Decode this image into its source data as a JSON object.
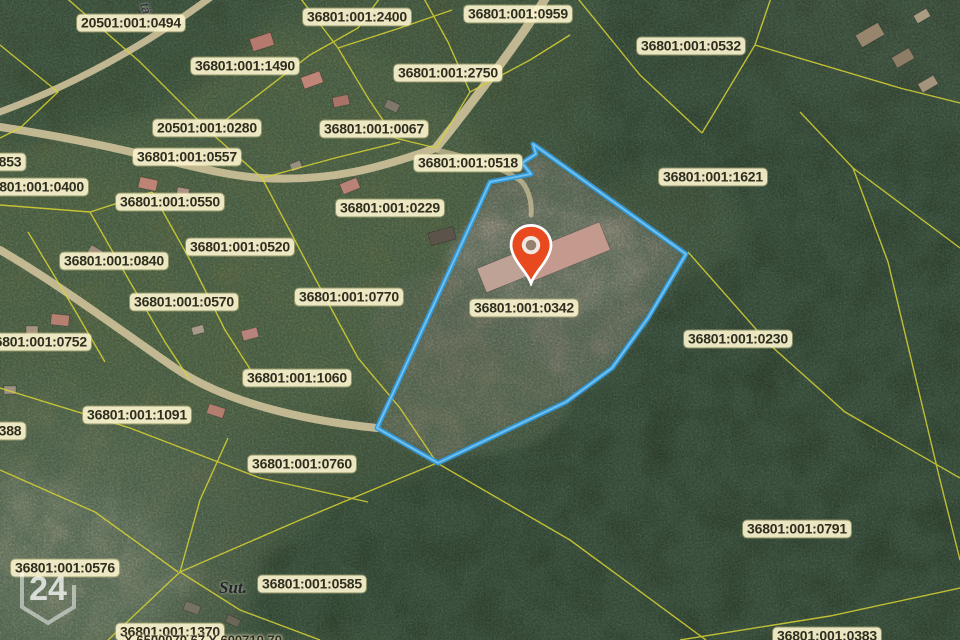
{
  "map": {
    "colors": {
      "selection_blue": "#2f9ce0",
      "selection_blue_light": "#7cc6ef",
      "boundary_yellow": "#d7d334",
      "pin_orange": "#e8491f",
      "road_tan": "#cfc29b",
      "label_bg": "rgba(250,243,205,0.92)",
      "label_text": "#2f2d1f"
    },
    "selected_parcel": "36801:001:0342",
    "parcel_labels": [
      {
        "text": "20501:001:0494",
        "x": 131,
        "y": 23
      },
      {
        "text": "36801:001:2400",
        "x": 357,
        "y": 17
      },
      {
        "text": "36801:001:0959",
        "x": 518,
        "y": 14
      },
      {
        "text": "36801:001:0532",
        "x": 691,
        "y": 46
      },
      {
        "text": "36801:001:1490",
        "x": 245,
        "y": 66
      },
      {
        "text": "36801:001:2750",
        "x": 448,
        "y": 73
      },
      {
        "text": "20501:001:0280",
        "x": 207,
        "y": 128
      },
      {
        "text": "36801:001:0067",
        "x": 374,
        "y": 129
      },
      {
        "text": "36801:001:0557",
        "x": 187,
        "y": 157
      },
      {
        "text": "853",
        "x": 10,
        "y": 162
      },
      {
        "text": "36801:001:0518",
        "x": 468,
        "y": 163,
        "layer": "under"
      },
      {
        "text": "36801:001:1621",
        "x": 713,
        "y": 177
      },
      {
        "text": "36801:001:0400",
        "x": 34,
        "y": 187
      },
      {
        "text": "36801:001:0550",
        "x": 170,
        "y": 202
      },
      {
        "text": "36801:001:0229",
        "x": 390,
        "y": 208
      },
      {
        "text": "36801:001:0520",
        "x": 240,
        "y": 247
      },
      {
        "text": "36801:001:0840",
        "x": 114,
        "y": 261
      },
      {
        "text": "36801:001:0770",
        "x": 349,
        "y": 297
      },
      {
        "text": "36801:001:0570",
        "x": 184,
        "y": 302
      },
      {
        "text": "36801:001:0342",
        "x": 524,
        "y": 308
      },
      {
        "text": "36801:001:0230",
        "x": 738,
        "y": 339
      },
      {
        "text": "36801:001:0752",
        "x": 37,
        "y": 342
      },
      {
        "text": "36801:001:1060",
        "x": 297,
        "y": 378
      },
      {
        "text": "36801:001:1091",
        "x": 137,
        "y": 415
      },
      {
        "text": "388",
        "x": 10,
        "y": 431
      },
      {
        "text": "36801:001:0760",
        "x": 302,
        "y": 464
      },
      {
        "text": "36801:001:0791",
        "x": 797,
        "y": 529
      },
      {
        "text": "36801:001:0576",
        "x": 65,
        "y": 568
      },
      {
        "text": "36801:001:0585",
        "x": 312,
        "y": 584
      },
      {
        "text": "36801:001:1370",
        "x": 170,
        "y": 632
      },
      {
        "text": "36801:001:0383",
        "x": 827,
        "y": 636
      }
    ],
    "place_names": [
      {
        "text": "Sut.",
        "x": 233,
        "y": 588
      }
    ],
    "street_name": {
      "text": "tän",
      "x": 147,
      "y": 12
    },
    "coordinates_readout": {
      "text": "X 6500070,67 Y 600710,70",
      "x": 203,
      "y": 640
    },
    "watermark": "24"
  }
}
